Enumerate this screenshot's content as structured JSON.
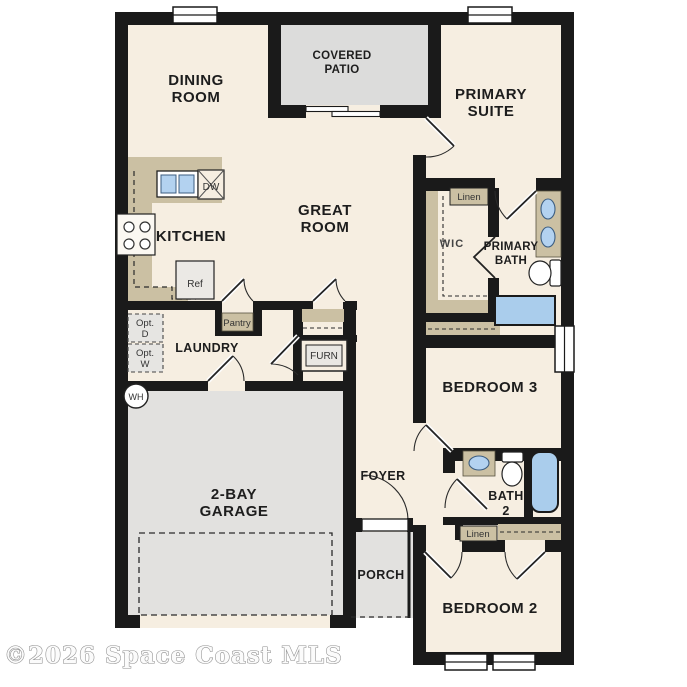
{
  "title": "Single-story house floor plan",
  "watermark": "©2026 Space Coast MLS",
  "colors": {
    "wall": "#1a1a1a",
    "floor": "#f6eee1",
    "patio_gray": "#dcdcdb",
    "garage_gray": "#e2e1df",
    "counter_tan": "#cbc0a3",
    "fixture_blue": "#b3d2f0",
    "watermark_gray": "#8c8c8c"
  },
  "rooms": {
    "dining_room": [
      "DINING",
      "ROOM"
    ],
    "covered_patio": [
      "COVERED",
      "PATIO"
    ],
    "primary_suite": [
      "PRIMARY",
      "SUITE"
    ],
    "kitchen": [
      "KITCHEN"
    ],
    "great_room": [
      "GREAT",
      "ROOM"
    ],
    "wic": [
      "WIC"
    ],
    "primary_bath": [
      "PRIMARY",
      "BATH"
    ],
    "laundry": [
      "LAUNDRY"
    ],
    "bedroom_3": [
      "BEDROOM 3"
    ],
    "garage": [
      "2-BAY",
      "GARAGE"
    ],
    "foyer": [
      "FOYER"
    ],
    "bath_2": [
      "BATH",
      "2"
    ],
    "porch": [
      "PORCH"
    ],
    "bedroom_2": [
      "BEDROOM 2"
    ]
  },
  "features": {
    "linen_primary": "Linen",
    "linen_bed2": "Linen",
    "pantry": "Pantry",
    "furnace": "FURN",
    "opt_dryer": [
      "Opt.",
      "D"
    ],
    "opt_washer": [
      "Opt.",
      "W"
    ],
    "water_heater": "WH",
    "refrigerator": "Ref",
    "dishwasher": "DW"
  }
}
